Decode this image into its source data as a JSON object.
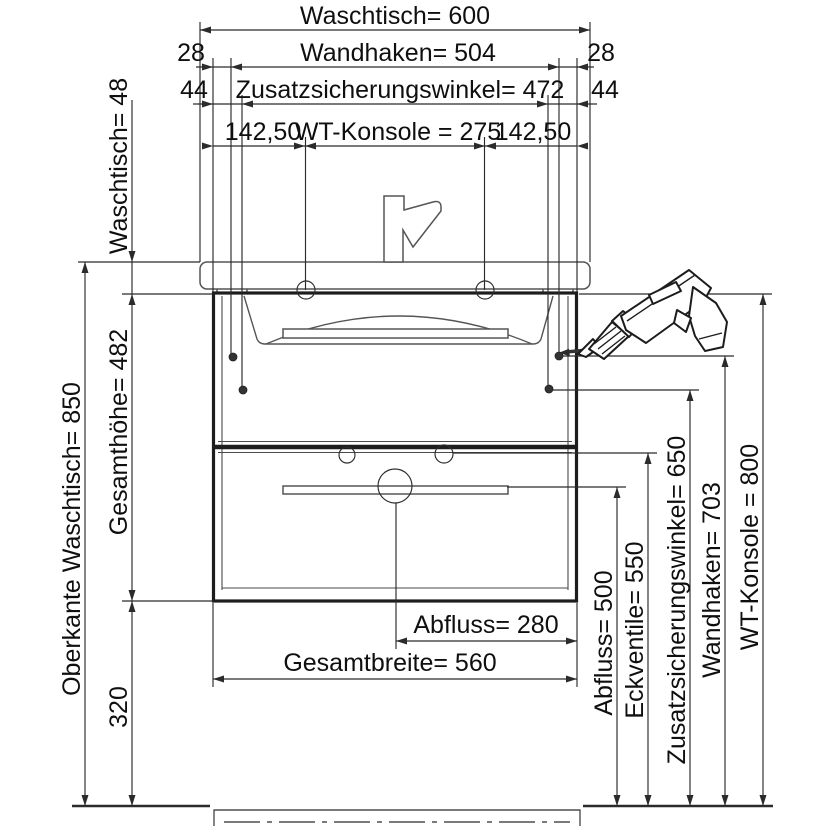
{
  "labels": {
    "top_width": "Waschtisch= 600",
    "hooks_width": "Wandhaken= 504",
    "hooks_offset_left": "28",
    "hooks_offset_right": "28",
    "bracket_width": "Zusatzsicherungswinkel= 472",
    "bracket_offset_left": "44",
    "bracket_offset_right": "44",
    "console_offset_left": "142,50",
    "console_width": "WT-Konsole = 275",
    "console_offset_right": "142,50",
    "basin_top_height": "Oberkante Waschtisch= 850",
    "basin_thickness": "Waschtisch= 48",
    "cabinet_height": "Gesamthöhe= 482",
    "floor_clearance": "320",
    "drain_offset": "Abfluss= 280",
    "total_width": "Gesamtbreite= 560",
    "drain_height": "Abfluss= 500",
    "valve_height": "Eckventile= 550",
    "bracket_height": "Zusatzsicherungswinkel= 650",
    "hook_height": "Wandhaken= 703",
    "console_height": "WT-Konsole = 800"
  },
  "icons": {
    "drill": "power-drill",
    "faucet": "faucet",
    "screw": "wall-screw"
  },
  "colors": {
    "line": "#2b2b2b",
    "drawing": "#555555",
    "cabinet": "#1d1d1d",
    "background": "#ffffff",
    "text": "#0f0f0f"
  }
}
